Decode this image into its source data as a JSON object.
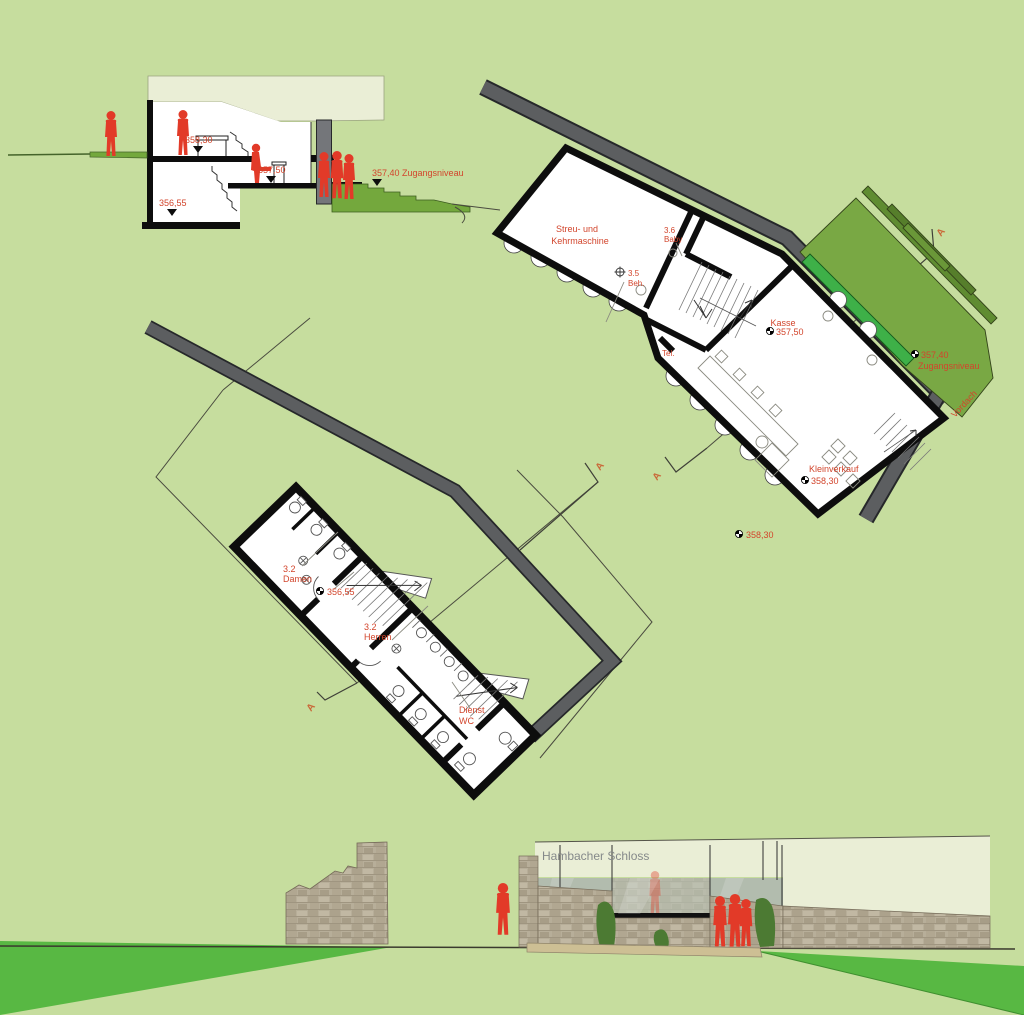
{
  "drawing": {
    "section": {
      "level_upper": "358,30",
      "level_mid": "357,50",
      "level_lower": "356,55",
      "level_entry": "357,40 Zugangsniveau"
    },
    "upper_plan": {
      "room_streu_line1": "Streu- und",
      "room_streu_line2": "Kehrmaschine",
      "room_baby_line1": "3.6",
      "room_baby_line2": "Baby",
      "room_beh_line1": "3.5",
      "room_beh_line2": "Beh.",
      "tel_label": "Tel.",
      "kasse_line1": "Kasse",
      "kasse_line2": "357,50",
      "kleinverkauf_line1": "Kleinverkauf",
      "kleinverkauf_line2": "358,30",
      "outside_level": "358,30",
      "entry_level_line1": "357,40",
      "entry_level_line2": "Zugangsniveau",
      "vordach_label": "Vordach",
      "section_marker": "A"
    },
    "lower_plan": {
      "damen_line1": "3.2",
      "damen_line2": "Damen",
      "level": "356,55",
      "herren_line1": "3.2",
      "herren_line2": "Herren",
      "dienst_line1": "Dienst",
      "dienst_line2": "WC",
      "section_marker": "A"
    },
    "elevation": {
      "title": "Hambacher Schloss"
    }
  },
  "colors": {
    "background": "#c6dd9e",
    "wall_black": "#0d0d0d",
    "band_gray": "#5c5e60",
    "band_edge": "#26282a",
    "plan_white": "#ffffff",
    "accent_red": "#e23a28",
    "label_red": "#d2452c",
    "marker_orange": "#c96a3a",
    "vordach_green": "#79a844",
    "vordach_step_green": "#5f8c31",
    "glass_strip_green": "#3eb048",
    "lawn_green": "#58b843",
    "terrain_green": "#74a83d",
    "roof_cream": "#eaeed6",
    "stone_tan": "#b7ae99",
    "glass_gray": "#b5beb2",
    "elevation_title_gray": "#85898a"
  }
}
